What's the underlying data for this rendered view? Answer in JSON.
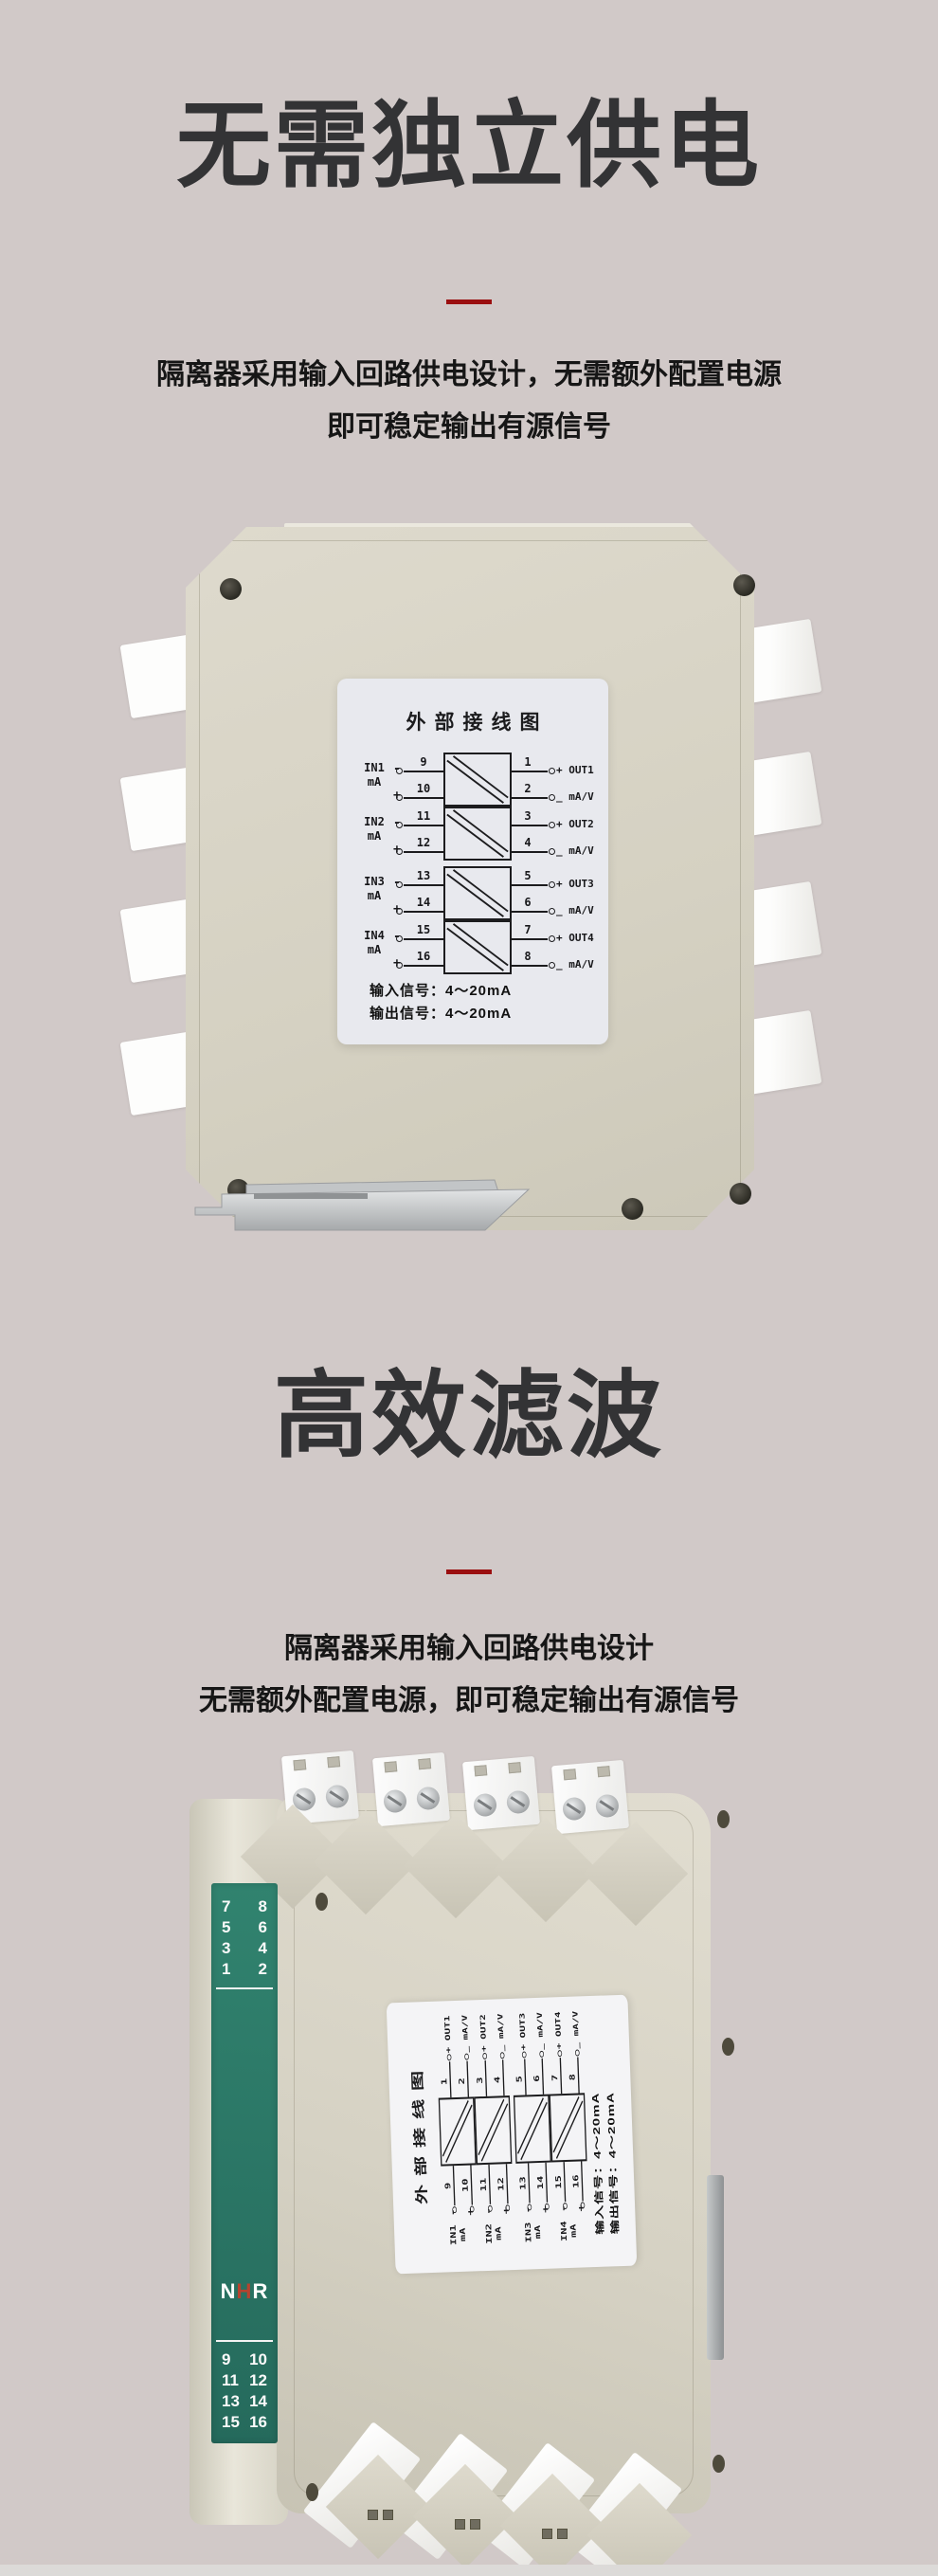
{
  "page": {
    "background": "#d1c9c8",
    "accent_red": "#9b0f10"
  },
  "sections": [
    {
      "title": "无需独立供电",
      "desc_lines": [
        "隔离器采用输入回路供电设计，无需额外配置电源",
        "即可稳定输出有源信号"
      ]
    },
    {
      "title": "高效滤波",
      "desc_lines": [
        "隔离器采用输入回路供电设计",
        "无需额外配置电源，即可稳定输出有源信号"
      ]
    }
  ],
  "wiring_label": {
    "title": "外部接线图",
    "minus_sign": "-",
    "plus_sign": "+",
    "channels": [
      {
        "in_name": "IN1",
        "in_unit": "mA",
        "in_minus_term": "9",
        "in_plus_term": "10",
        "out_plus_term": "1",
        "out_minus_term": "2",
        "out_line1": "+ OUT1",
        "out_line2": "_ mA/V"
      },
      {
        "in_name": "IN2",
        "in_unit": "mA",
        "in_minus_term": "11",
        "in_plus_term": "12",
        "out_plus_term": "3",
        "out_minus_term": "4",
        "out_line1": "+ OUT2",
        "out_line2": "_ mA/V"
      },
      {
        "in_name": "IN3",
        "in_unit": "mA",
        "in_minus_term": "13",
        "in_plus_term": "14",
        "out_plus_term": "5",
        "out_minus_term": "6",
        "out_line1": "+ OUT3",
        "out_line2": "_ mA/V"
      },
      {
        "in_name": "IN4",
        "in_unit": "mA",
        "in_minus_term": "15",
        "in_plus_term": "16",
        "out_plus_term": "7",
        "out_minus_term": "8",
        "out_line1": "+ OUT4",
        "out_line2": "_ mA/V"
      }
    ],
    "signal_lines": [
      "输入信号：4～20mA",
      "输出信号：4～20mA"
    ]
  },
  "side_panel": {
    "top_terminals": [
      [
        "7",
        "8"
      ],
      [
        "5",
        "6"
      ],
      [
        "3",
        "4"
      ],
      [
        "1",
        "2"
      ]
    ],
    "bottom_terminals": [
      [
        "9",
        "10"
      ],
      [
        "11",
        "12"
      ],
      [
        "13",
        "14"
      ],
      [
        "15",
        "16"
      ]
    ],
    "logo": {
      "l1": "N",
      "l2": "H",
      "l3": "R",
      "accent": "#b5432f"
    }
  }
}
